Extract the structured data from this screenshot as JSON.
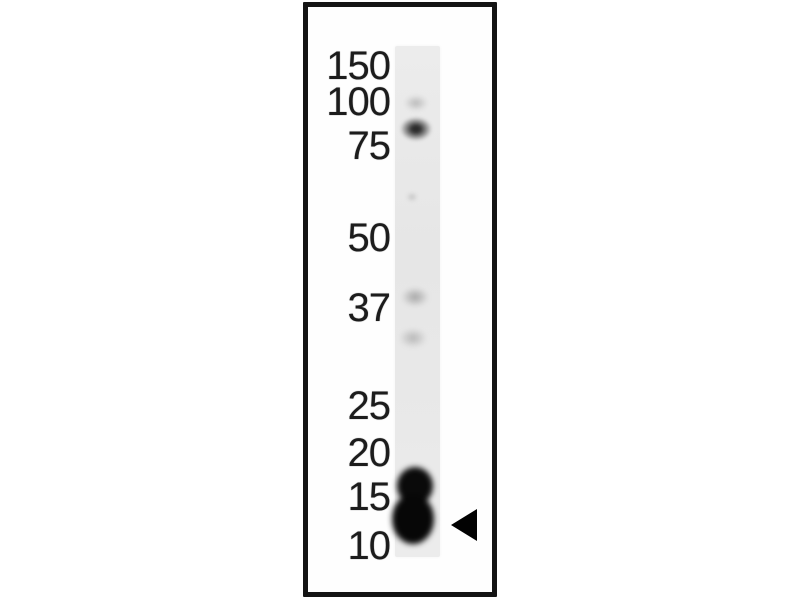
{
  "figure": {
    "type": "western-blot",
    "description": "Single-lane western blot with molecular weight ladder and arrowhead marking the detected band",
    "ladder": {
      "markers": [
        {
          "label": "150"
        },
        {
          "label": "100"
        },
        {
          "label": "75"
        },
        {
          "label": "50"
        },
        {
          "label": "37"
        },
        {
          "label": "25"
        },
        {
          "label": "20"
        },
        {
          "label": "15"
        },
        {
          "label": "10"
        }
      ]
    },
    "lane": {
      "count": 1,
      "bands": [
        {
          "name": "faint-smudge",
          "position_vs_ladder": "slightly above 100",
          "intensity": "very-faint"
        },
        {
          "name": "band",
          "position_vs_ladder": "just below 100",
          "intensity": "medium-dark"
        },
        {
          "name": "speck",
          "position_vs_ladder": "between 75 and 50",
          "intensity": "trace"
        },
        {
          "name": "faint-band",
          "position_vs_ladder": "at 37",
          "intensity": "faint"
        },
        {
          "name": "faint-band",
          "position_vs_ladder": "just below 37",
          "intensity": "very-faint"
        },
        {
          "name": "major-doublet-band",
          "position_vs_ladder": "between 15 and 10",
          "intensity": "saturated-black"
        }
      ]
    },
    "pointer": {
      "icon": "left-arrowhead-icon",
      "points_to": "major-doublet-band"
    }
  },
  "colors": {
    "background": "#ffffff",
    "frame_border": "#141414",
    "lane_fill": "#e9e9e9",
    "marker_text": "#1c1c1c",
    "major_band": "#0a0a0a",
    "arrowhead": "#020202"
  }
}
